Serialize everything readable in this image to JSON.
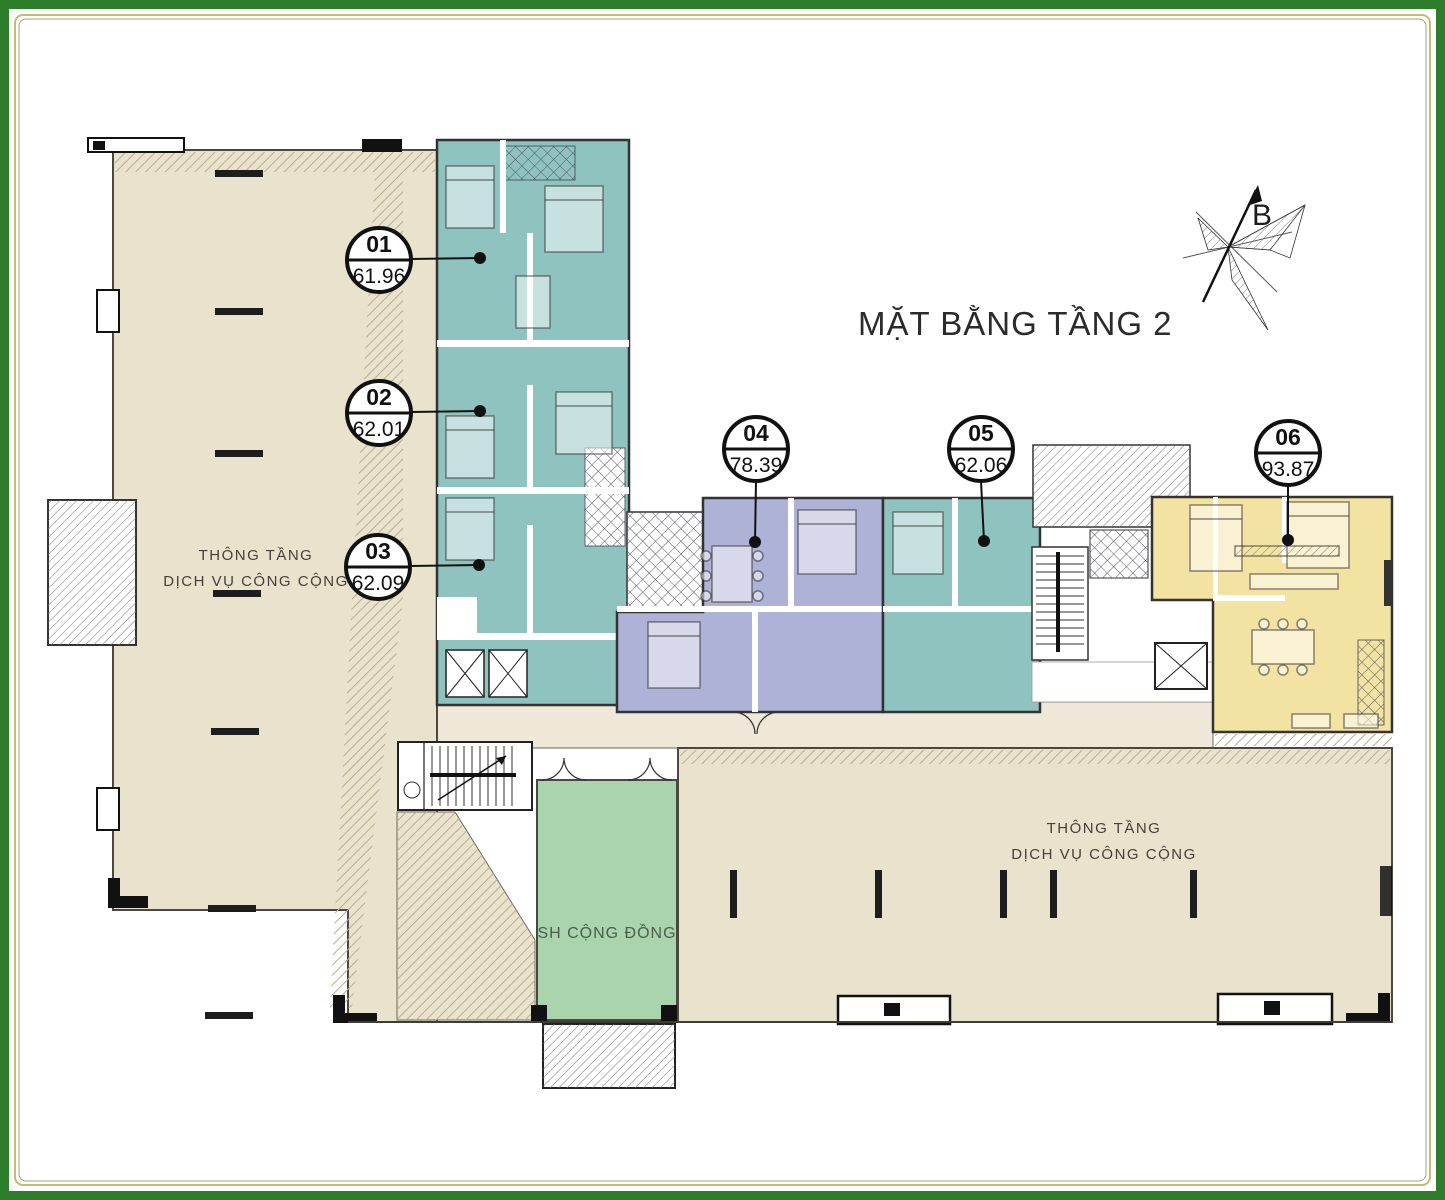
{
  "title": "MẶT BẰNG TẦNG 2",
  "compass": {
    "label": "B"
  },
  "units": [
    {
      "number": "01",
      "area": "61.96"
    },
    {
      "number": "02",
      "area": "62.01"
    },
    {
      "number": "03",
      "area": "62.09"
    },
    {
      "number": "04",
      "area": "78.39"
    },
    {
      "number": "05",
      "area": "62.06"
    },
    {
      "number": "06",
      "area": "93.87"
    }
  ],
  "labels": {
    "void_left_line1": "THÔNG TẦNG",
    "void_left_line2": "DỊCH VỤ CÔNG CỘNG",
    "void_right_line1": "THÔNG TẦNG",
    "void_right_line2": "DỊCH VỤ CÔNG CỘNG",
    "community": "SH CỘNG ĐỒNG"
  },
  "colors": {
    "frame_green": "#2e7d2b",
    "frame_gold": "#c9b878",
    "void_beige": "#e9e2cc",
    "corridor_beige": "#efe8d9",
    "unit_teal": "#8fc3c0",
    "unit_purple": "#aeb2d6",
    "unit_yellow": "#f3e3a3",
    "community_green": "#a9d4ae"
  }
}
